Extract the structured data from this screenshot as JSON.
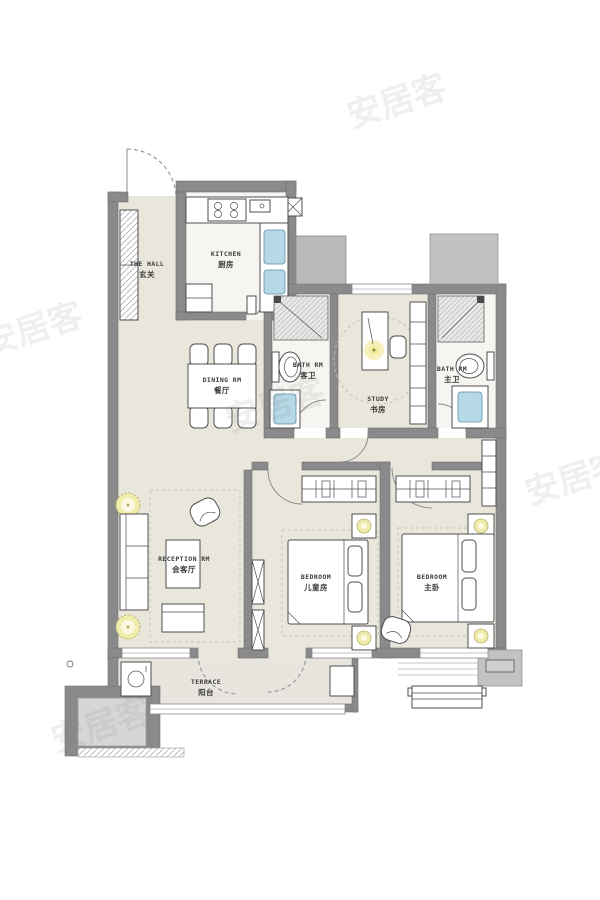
{
  "watermark": "安居客",
  "rooms": [
    {
      "id": "hall",
      "en": "THE HALL",
      "zh": "玄关"
    },
    {
      "id": "kitchen",
      "en": "KITCHEN",
      "zh": "厨房"
    },
    {
      "id": "dining",
      "en": "DINING RM",
      "zh": "餐厅"
    },
    {
      "id": "bath-guest",
      "en": "BATH RM",
      "zh": "客卫"
    },
    {
      "id": "study",
      "en": "STUDY",
      "zh": "书房"
    },
    {
      "id": "bath-master",
      "en": "BATH RM",
      "zh": "主卫"
    },
    {
      "id": "reception",
      "en": "RECEPTION RM",
      "zh": "会客厅"
    },
    {
      "id": "bedroom-kids",
      "en": "BEDROOM",
      "zh": "儿童房"
    },
    {
      "id": "bedroom-master",
      "en": "BEDROOM",
      "zh": "主卧"
    },
    {
      "id": "terrace",
      "en": "TERRACE",
      "zh": "阳台"
    }
  ],
  "colors": {
    "wall": "#8a8a8a",
    "floor": "#e9e6db",
    "tile": "#f6f5f1",
    "accent_yellow": "#f0ecab",
    "accent_blue": "#b5d9e6",
    "watermark_gray": "#bdbdbd"
  }
}
